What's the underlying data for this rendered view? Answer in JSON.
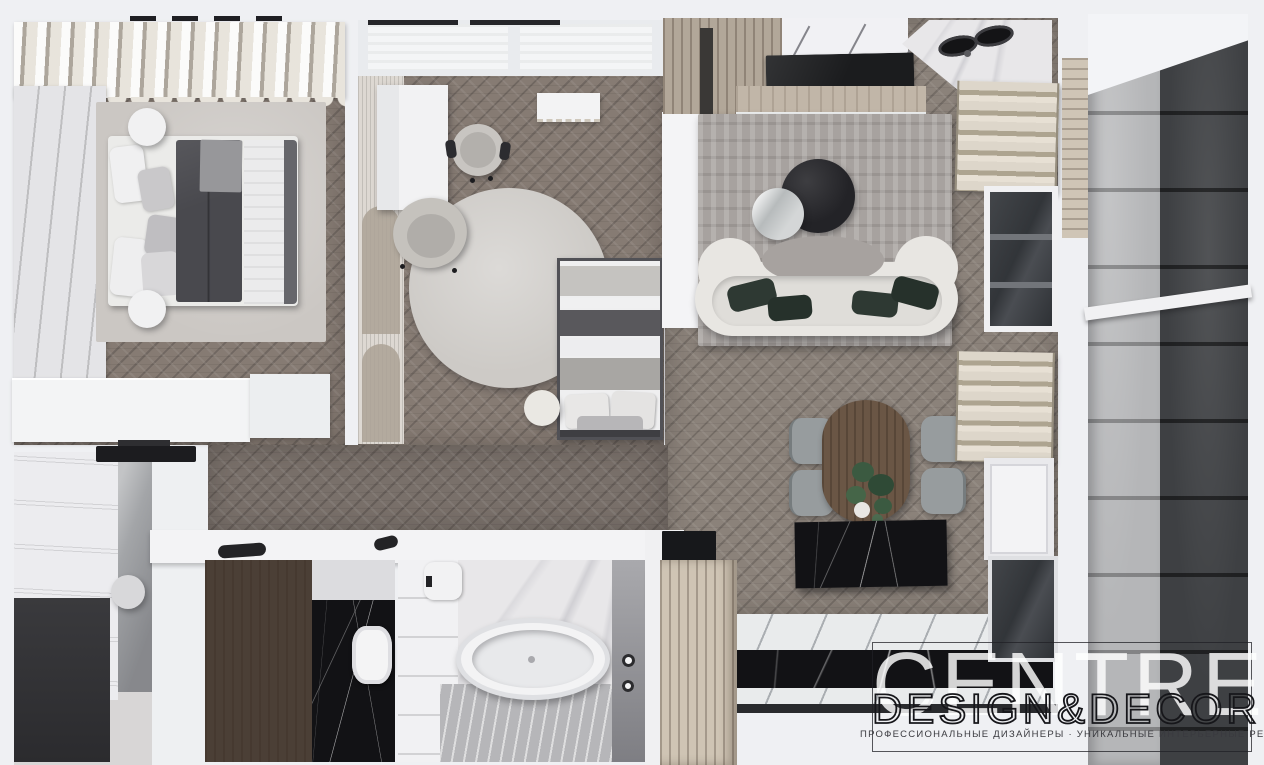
{
  "watermark": {
    "brand": "CENTRE",
    "subbrand": "DESIGN&DECOR",
    "tagline": "ПРОФЕССИОНАЛЬНЫЕ ДИЗАЙНЕРЫ · УНИКАЛЬНЫЕ ИНТЕРЬЕРНЫЕ РЕШЕНИЯ"
  },
  "colors": {
    "canvas": "#eff0f3",
    "floor-wood": "#867b73",
    "floor-wood-living": "#8b827a",
    "floor-corridor": "#79706a",
    "rug-light": "#cbc7c3",
    "rug-living": "#a7a29f",
    "bed-duvet": "#49494e",
    "sofa": "#e8e6e2",
    "pillow-green": "#2e3933",
    "table-wood": "#6a5645",
    "chair-grey": "#979c9e",
    "marble-black": "#121215",
    "tile-light": "#b5b6b8",
    "tile-dark": "#3e4043",
    "shade-beige": "#cfc7bb",
    "wood-dark": "#4b3f36",
    "wood-light": "#cfc4b4",
    "marble-white": "#e7e6e8",
    "wm-white": "rgba(255,255,255,0.82)",
    "wm-ink": "#16161a"
  }
}
